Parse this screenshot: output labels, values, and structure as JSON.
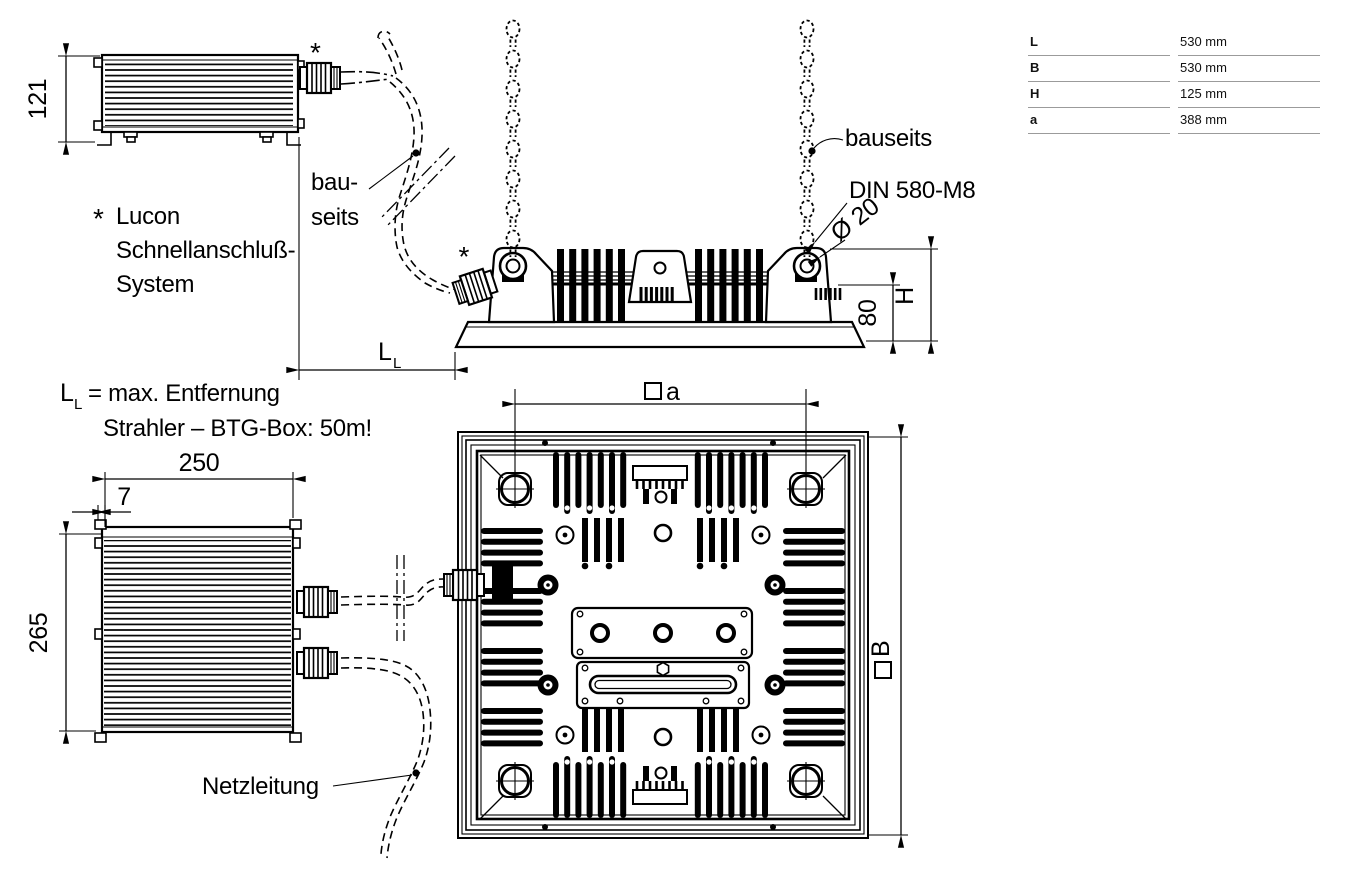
{
  "drawing": {
    "notes": {
      "asterisk": "*",
      "lucon": [
        "Lucon",
        "Schnellanschluß-",
        "System"
      ],
      "ll_symbol_main": "L",
      "ll_symbol_sub": "L",
      "ll_note_rest": "= max. Entfernung",
      "ll_note_line2": "Strahler – BTG-Box: 50m!",
      "bau_line1": "bau-",
      "bau_line2": "seits",
      "bauseits": "bauseits",
      "din_ring": "DIN 580-M8",
      "diameter": "Ø 20",
      "netzleitung": "Netzleitung"
    },
    "dimensions": {
      "box_height": "121",
      "box_width": "250",
      "bracket_offset": "7",
      "box_depth": "265",
      "mount_height": "80",
      "height_symbol": "H",
      "spacing_letter": "a",
      "width_letter": "B"
    }
  },
  "spec_table": {
    "rows": [
      {
        "label": "L",
        "value": "530 mm"
      },
      {
        "label": "B",
        "value": "530 mm"
      },
      {
        "label": "H",
        "value": "125 mm"
      },
      {
        "label": "a",
        "value": "388 mm"
      }
    ]
  }
}
